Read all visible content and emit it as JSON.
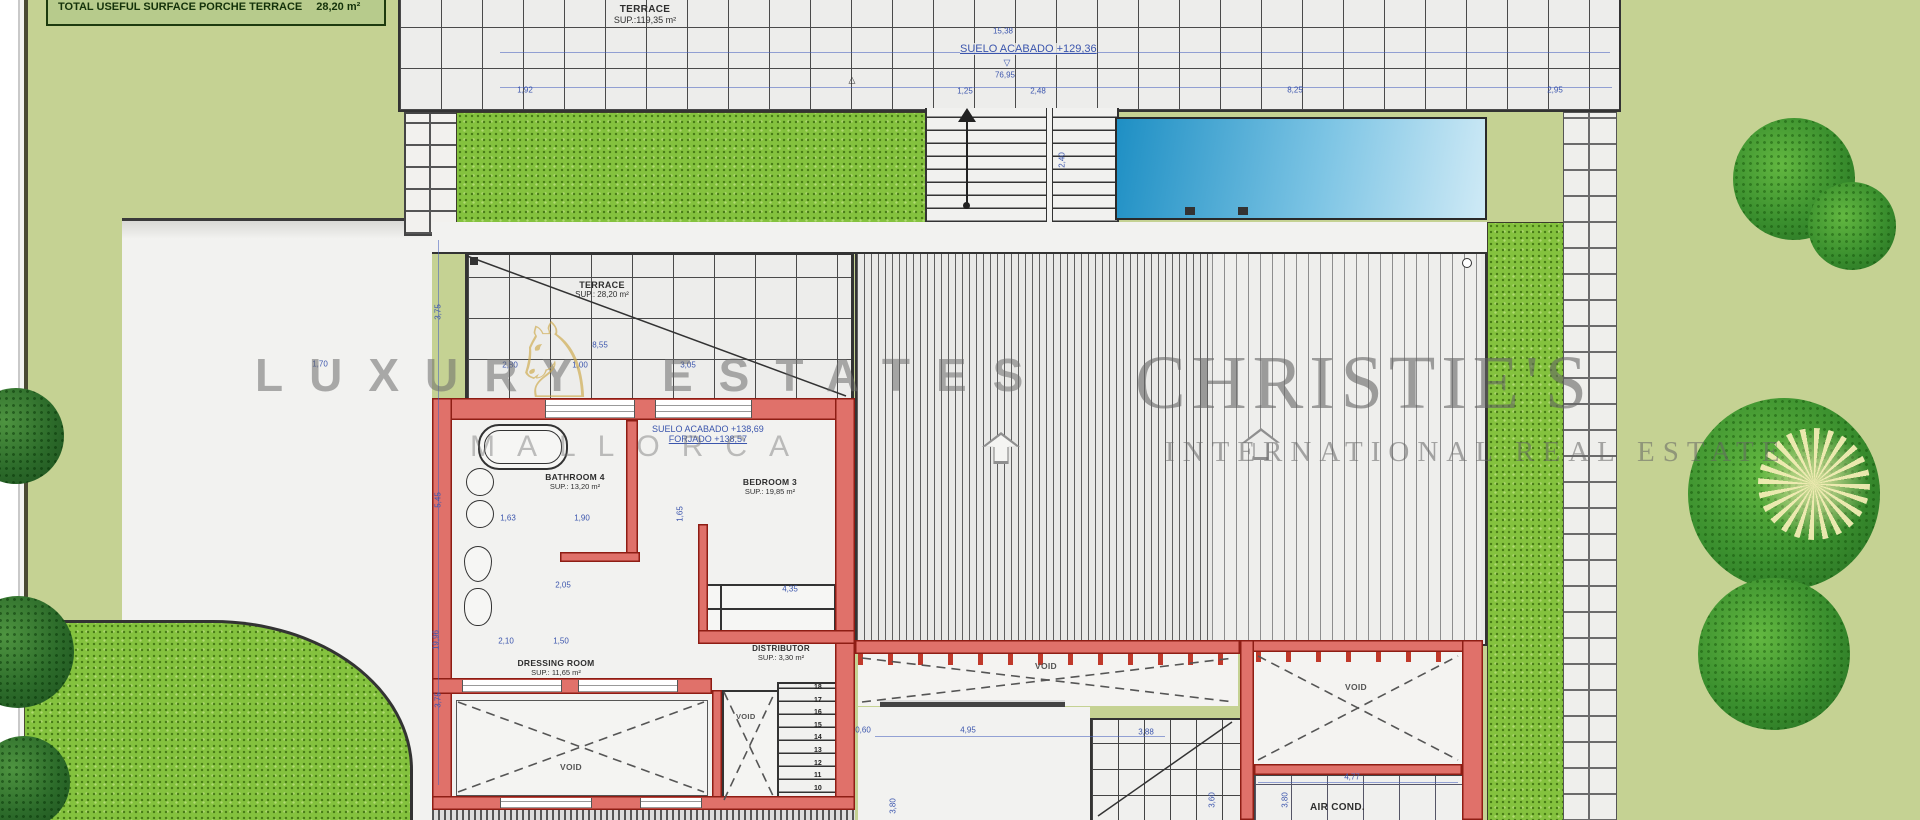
{
  "legend": {
    "row_label": "TOTAL USEFUL SURFACE PORCHE TERRACE",
    "row_value": "28,20 m²"
  },
  "plan": {
    "terrace_top": {
      "name": "TERRACE",
      "area": "SUP.:119,35 m²"
    },
    "level_top": "SUELO ACABADO +129,36",
    "terrace_small": {
      "name": "TERRACE",
      "area": "SUP.: 28,20 m²"
    },
    "level_interior": {
      "line1": "SUELO ACABADO +138,69",
      "line2": "FORJADO +138,57"
    },
    "bathroom": {
      "name": "BATHROOM 4",
      "area": "SUP.: 13,20 m²"
    },
    "bedroom": {
      "name": "BEDROOM 3",
      "area": "SUP.: 19,85 m²"
    },
    "distributor": {
      "name": "DISTRIBUTOR",
      "area": "SUP.: 3,30 m²"
    },
    "dressing": {
      "name": "DRESSING ROOM",
      "area": "SUP.: 11,65 m²"
    },
    "void_label": "VOID",
    "air_cond": "AIR COND.",
    "stair_numbers": [
      "18",
      "17",
      "16",
      "15",
      "14",
      "13",
      "12",
      "11",
      "10"
    ]
  },
  "markers": {
    "triangle_down": "▽",
    "triangle_up": "△"
  },
  "watermarks": {
    "left_word1": "LUXURY",
    "left_word2": "ESTATES",
    "left_sub": "MALLORCA",
    "right_main": "CHRISTIE'S",
    "right_sub": "INTERNATIONAL REAL ESTATE",
    "horse_glyph": "♘"
  },
  "dimensions": [
    {
      "t": "1,92",
      "x": 525,
      "y": 90
    },
    {
      "t": "1,25",
      "x": 965,
      "y": 91
    },
    {
      "t": "2,48",
      "x": 1038,
      "y": 91
    },
    {
      "t": "8,25",
      "x": 1295,
      "y": 90
    },
    {
      "t": "2,95",
      "x": 1555,
      "y": 90
    },
    {
      "t": "15,38",
      "x": 1003,
      "y": 31
    },
    {
      "t": "76,95",
      "x": 1005,
      "y": 75
    },
    {
      "t": "8,55",
      "x": 600,
      "y": 345
    },
    {
      "t": "1,70",
      "x": 320,
      "y": 364
    },
    {
      "t": "2,80",
      "x": 510,
      "y": 365
    },
    {
      "t": "1,00",
      "x": 580,
      "y": 365
    },
    {
      "t": "3,05",
      "x": 688,
      "y": 365
    },
    {
      "t": "3,75",
      "x": 438,
      "y": 312,
      "v": true
    },
    {
      "t": "5,45",
      "x": 438,
      "y": 500,
      "v": true
    },
    {
      "t": "19,96",
      "x": 436,
      "y": 640,
      "v": true
    },
    {
      "t": "3,75",
      "x": 438,
      "y": 700,
      "v": true
    },
    {
      "t": "1,63",
      "x": 508,
      "y": 518
    },
    {
      "t": "1,90",
      "x": 582,
      "y": 518
    },
    {
      "t": "1,65",
      "x": 680,
      "y": 514,
      "v": true
    },
    {
      "t": "2,05",
      "x": 563,
      "y": 585
    },
    {
      "t": "2,10",
      "x": 506,
      "y": 641
    },
    {
      "t": "1,50",
      "x": 561,
      "y": 641
    },
    {
      "t": "4,35",
      "x": 790,
      "y": 589
    },
    {
      "t": "0,60",
      "x": 863,
      "y": 730
    },
    {
      "t": "4,95",
      "x": 968,
      "y": 730
    },
    {
      "t": "3,88",
      "x": 1146,
      "y": 732
    },
    {
      "t": "3,80",
      "x": 893,
      "y": 806,
      "v": true
    },
    {
      "t": "3,60",
      "x": 1212,
      "y": 800,
      "v": true
    },
    {
      "t": "3,80",
      "x": 1285,
      "y": 800,
      "v": true
    },
    {
      "t": "4,77",
      "x": 1352,
      "y": 777
    },
    {
      "t": "2,40",
      "x": 1062,
      "y": 160,
      "v": true
    }
  ],
  "colors": {
    "accent_blue": "#3b55ad",
    "wall_red": "#e0716a",
    "wall_red_edge": "#8e1d14",
    "pool_dark": "#1e8fc4",
    "pool_light": "#cfeaf6",
    "grass": "#84c23e",
    "pale_green": "#c5d293",
    "gold": "#cda846"
  }
}
